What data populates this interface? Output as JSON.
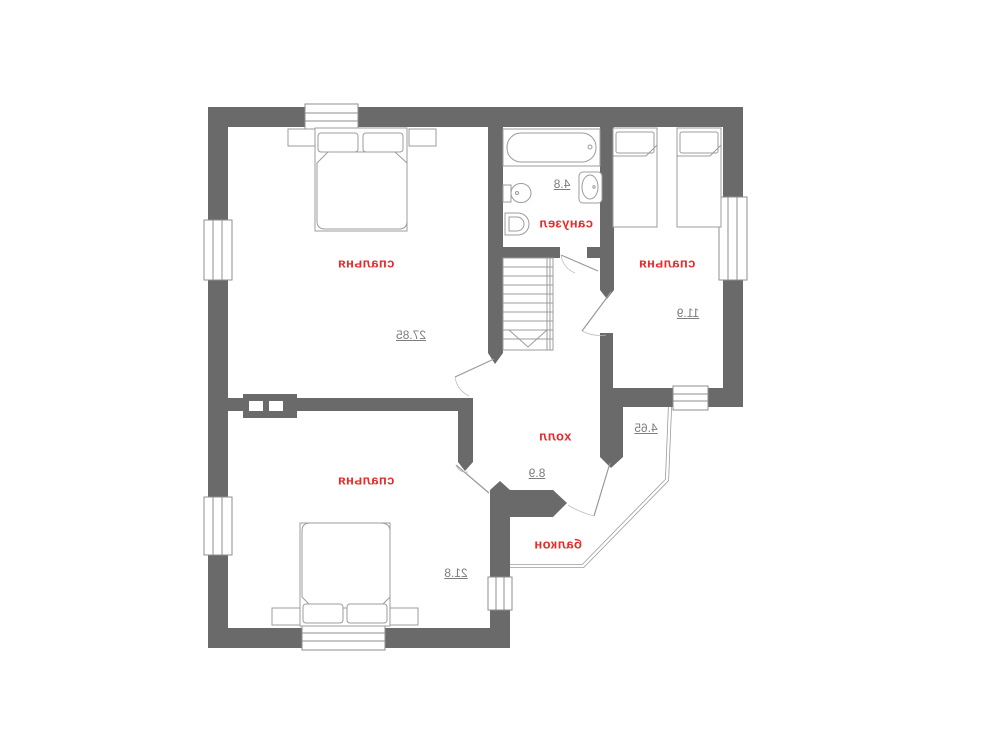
{
  "rooms": [
    {
      "name": "спальня",
      "area": "27.85"
    },
    {
      "name": "санузел",
      "area": "4.8"
    },
    {
      "name": "спальня",
      "area": "11.9"
    },
    {
      "name": "холл",
      "area": "8.9"
    },
    {
      "name": "спальня",
      "area": "21.8"
    },
    {
      "name": "балкон",
      "area": "4.65"
    }
  ],
  "colors": {
    "wall": "#6a6a6a",
    "room_label": "#e62b2b",
    "area_label": "#7d7d7d",
    "furniture_line": "#9c9c9c",
    "frame_line": "#8f8f8f",
    "background": "#ffffff"
  }
}
